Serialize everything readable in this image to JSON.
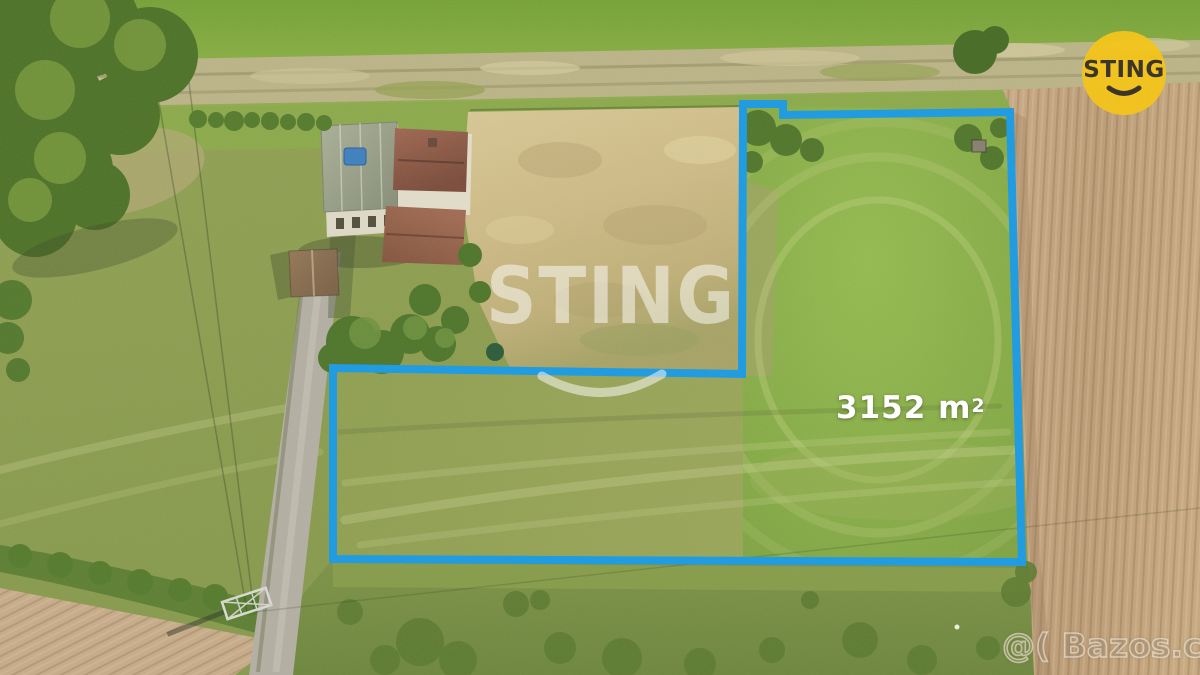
{
  "overlays": {
    "area_label": {
      "value": "3152",
      "unit": "m",
      "exponent": "2"
    },
    "center_watermark": {
      "text": "STING"
    },
    "corner_logo": {
      "text": "STING"
    },
    "bottom_watermark": {
      "text": "@( Bazos.cz"
    }
  },
  "colors": {
    "boundary_blue": "#1d9be2",
    "logo_yellow": "#f2c41c",
    "logo_text": "#3b352a",
    "watermark_white": "#ffffff"
  }
}
